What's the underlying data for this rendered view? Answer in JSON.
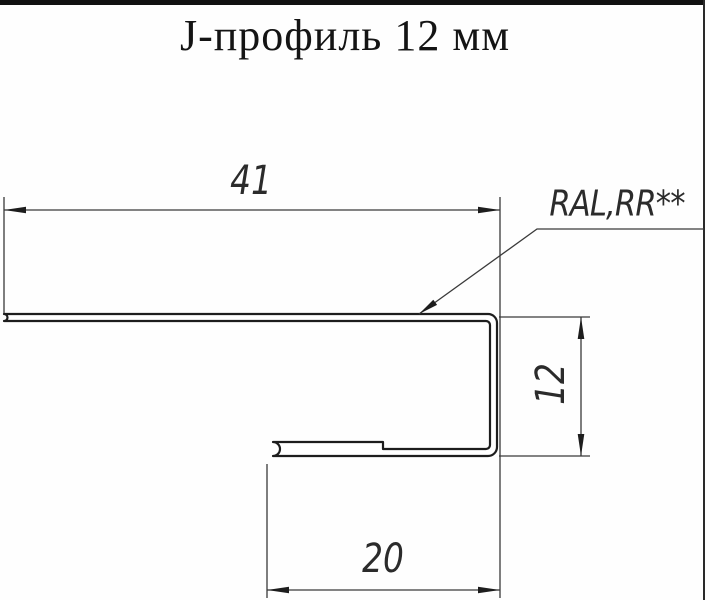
{
  "header": {
    "title": "J-профиль 12 мм"
  },
  "drawing": {
    "profile_name": "j-profile-cross-section",
    "dim_top_width": "41",
    "dim_right_height": "12",
    "dim_bottom_width": "20",
    "coating_label": "RAL,RR**",
    "line_color": "#1d1d1d",
    "background_color": "#fefefe"
  }
}
